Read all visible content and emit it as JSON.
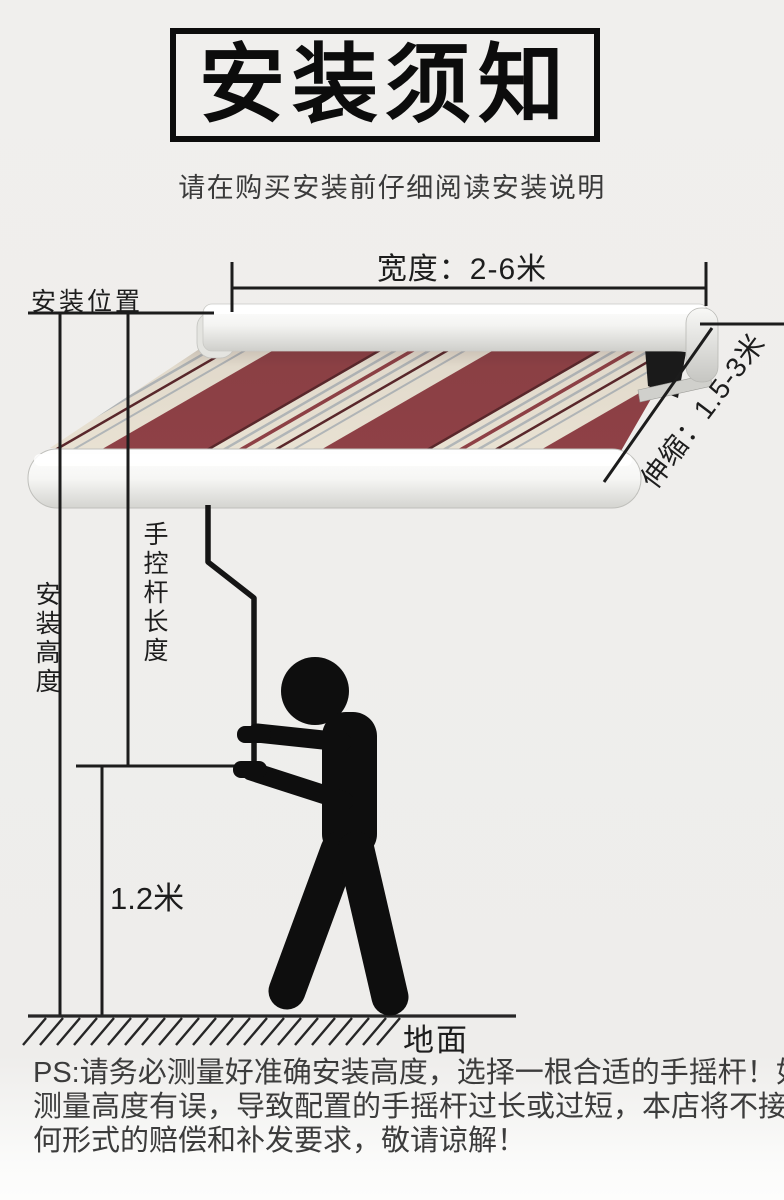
{
  "title": {
    "text": "安装须知"
  },
  "subtitle": {
    "text": "请在购买安装前仔细阅读安装说明"
  },
  "diagram": {
    "labels": {
      "width": "宽度：2-6米",
      "install_position": "安装位置",
      "install_height": "安装高度",
      "rod_length": "手控杆长度",
      "extension": "伸缩：1.5-3米",
      "hand_height": "1.2米",
      "ground": "地面"
    },
    "dimensions": {
      "width_range_m": "2-6",
      "extension_range_m": "1.5-3",
      "hand_height_m": "1.2"
    },
    "colors": {
      "background": "#efeeec",
      "line": "#1c1c1c",
      "person": "#0e0e0e",
      "fabric_maroon": "#8f4146",
      "fabric_cream": "#eae3d4",
      "fabric_dark_stripe": "#5a272b",
      "fabric_gray_stripe": "#b3b8ba",
      "cassette_white": "#fafaf8"
    }
  },
  "ps_note": {
    "lines": [
      "PS:请务必测量好准确安装高度，选择一根合适的手摇杆！如果",
      "测量高度有误，导致配置的手摇杆过长或过短，本店将不接受任",
      "何形式的赔偿和补发要求，敬请谅解！"
    ]
  }
}
